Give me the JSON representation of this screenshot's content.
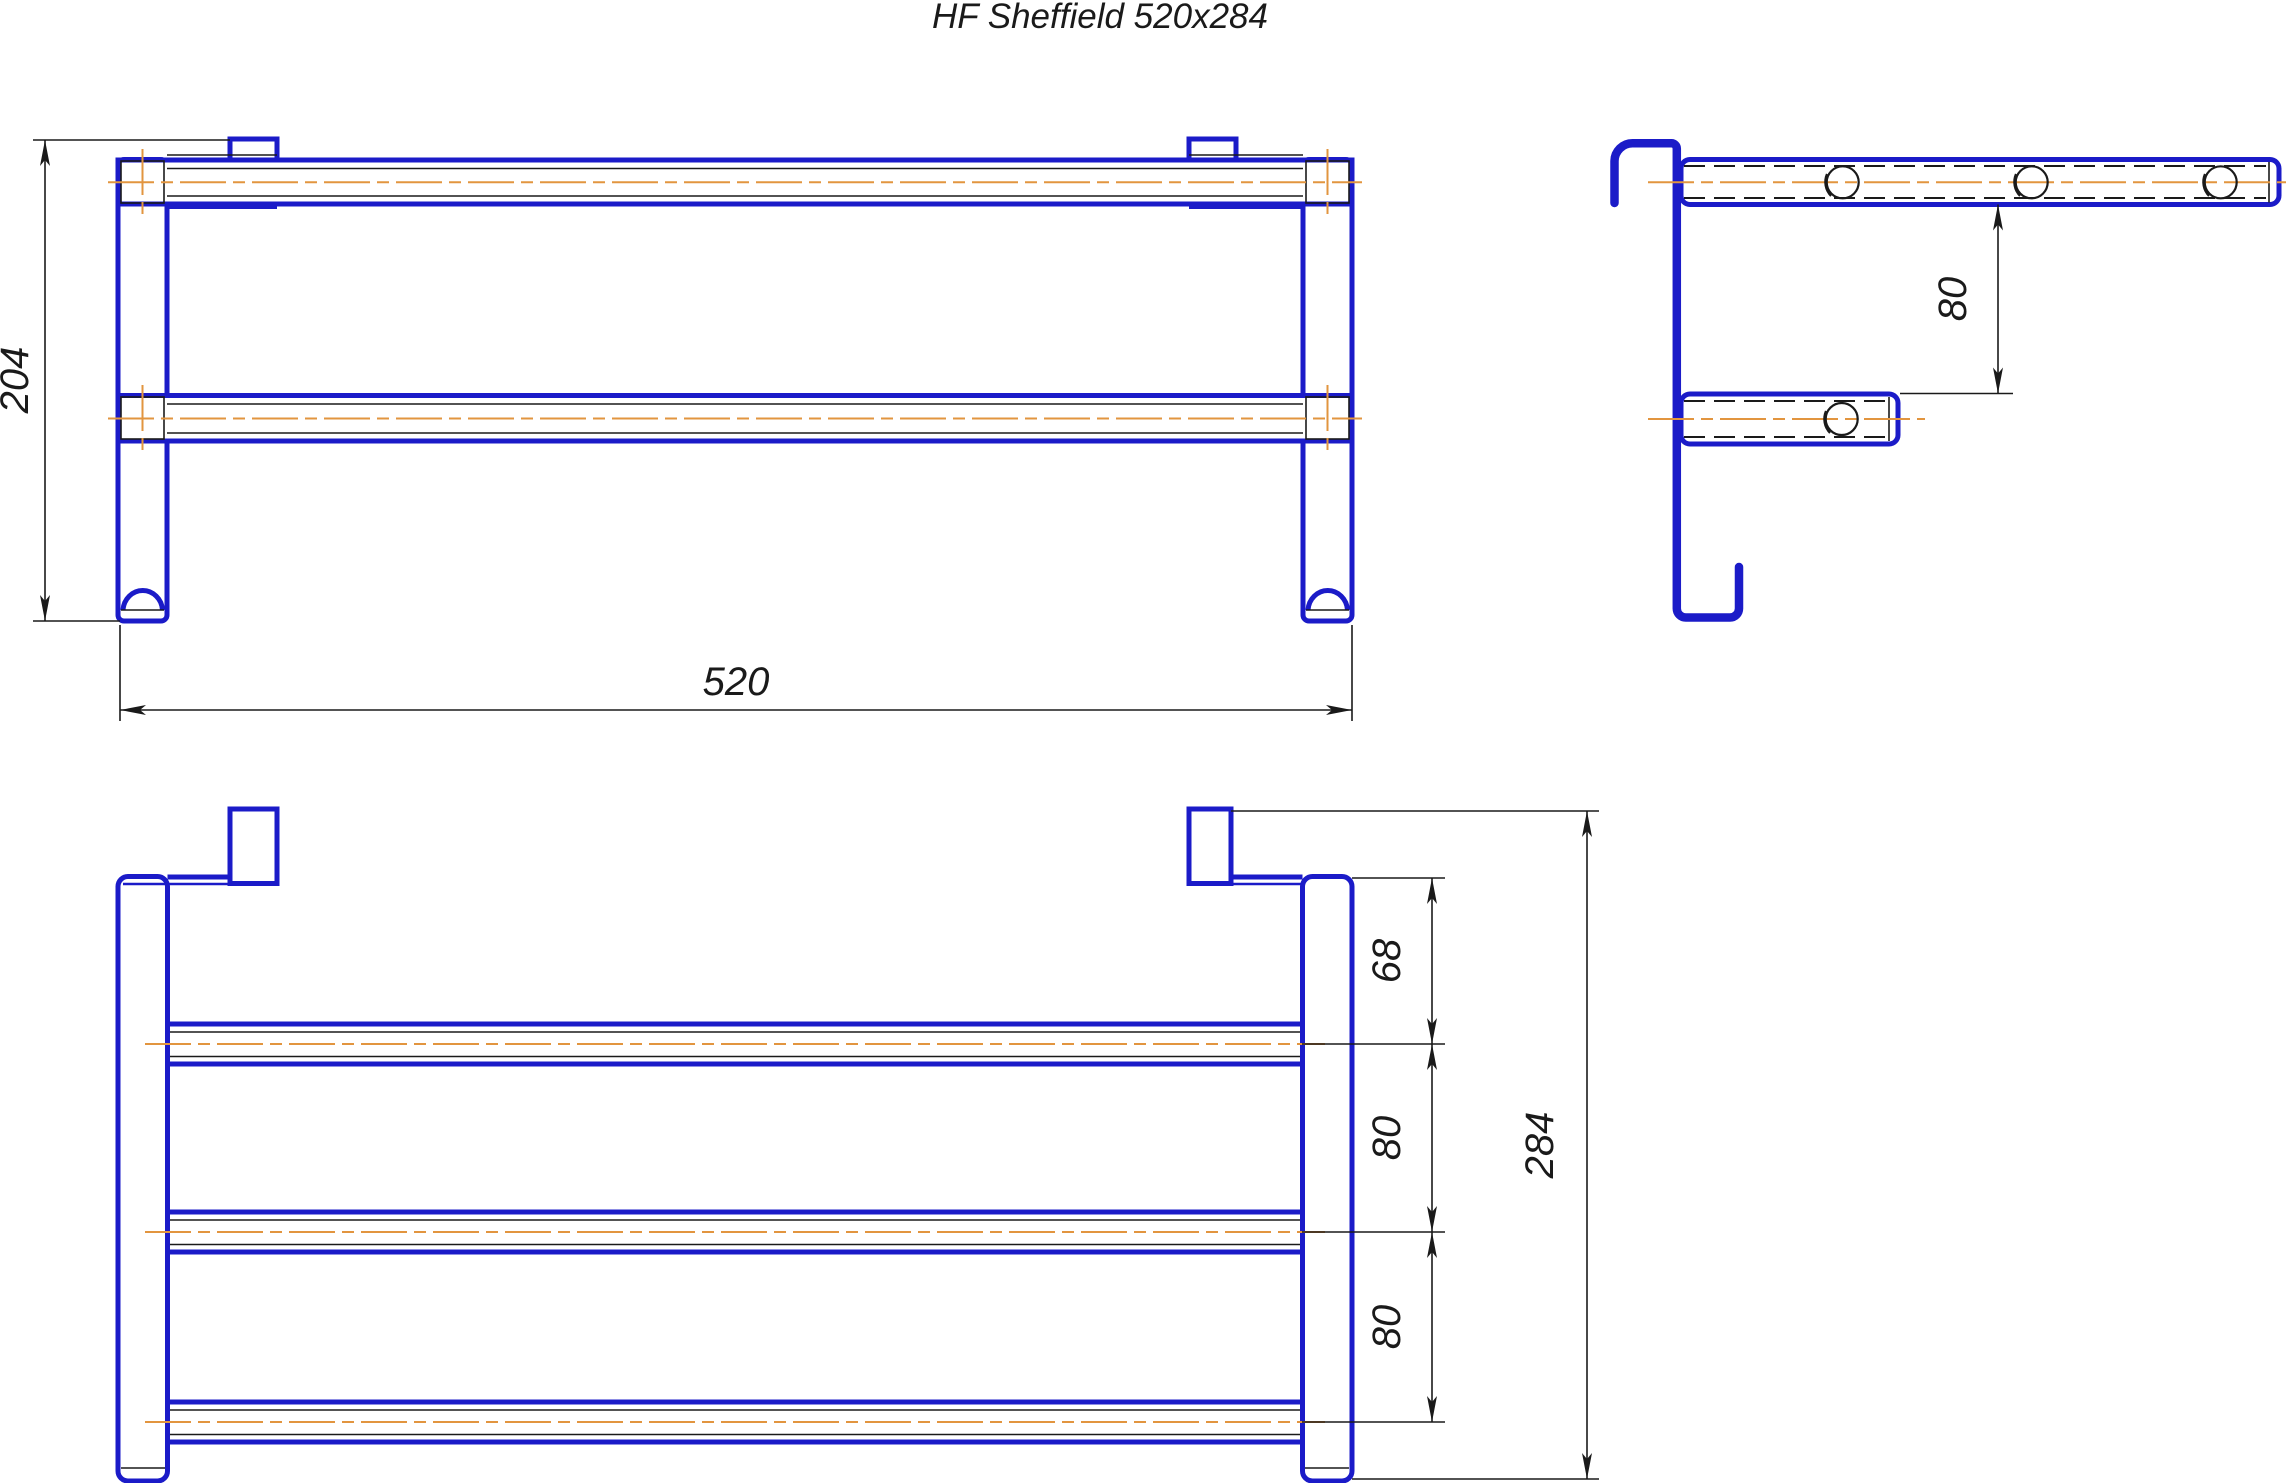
{
  "title": "HF Sheffield 520x284",
  "colors": {
    "outline_blue": "#1b1bc8",
    "centerline_orange": "#e2953f",
    "dimension_black": "#1a1a1a",
    "background": "#ffffff"
  },
  "front_view": {
    "height_dim": "204",
    "width_dim": "520"
  },
  "side_view": {
    "bar_gap_dim": "80"
  },
  "plan_view": {
    "front_gap_dim": "68",
    "bar_spacing_dim_1": "80",
    "bar_spacing_dim_2": "80",
    "depth_dim": "284"
  }
}
